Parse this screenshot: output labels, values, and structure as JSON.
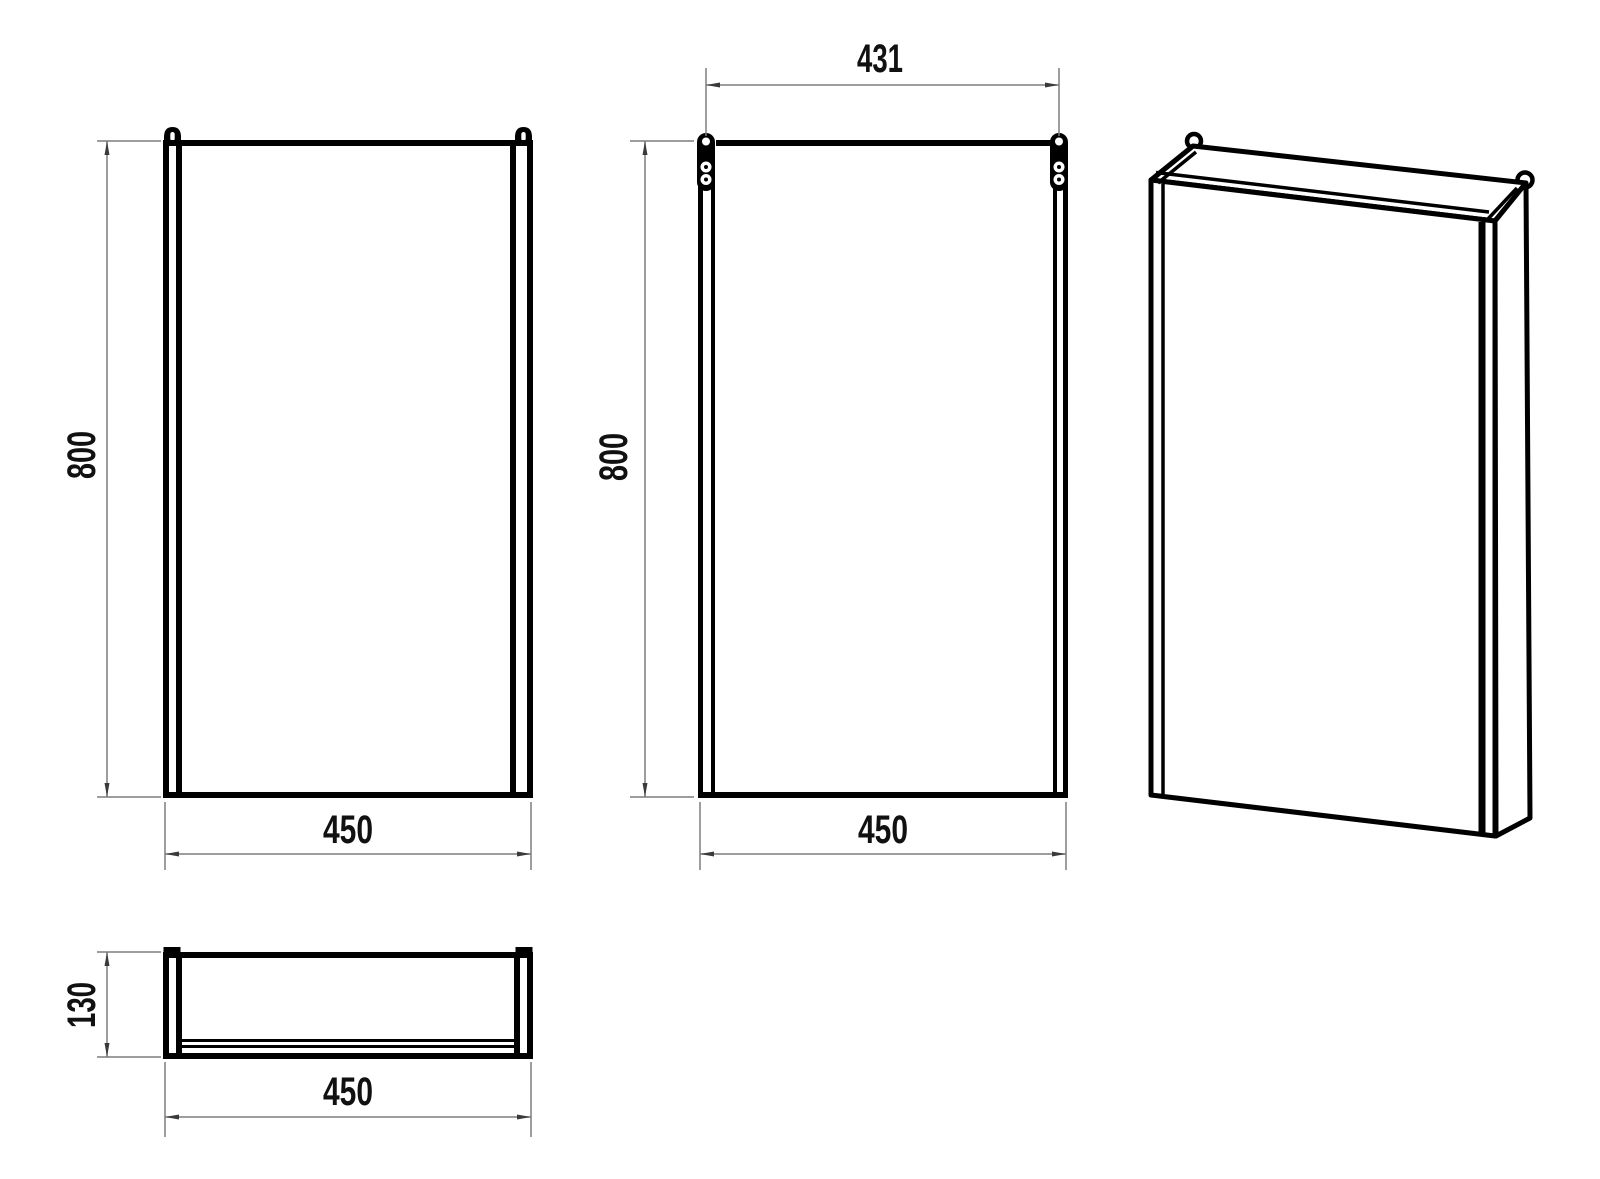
{
  "document": {
    "type": "technical-drawing",
    "subject": "wall-hung cabinet dimensional drawing"
  },
  "views": {
    "front": {
      "height": "800",
      "width": "450"
    },
    "back": {
      "height": "800",
      "width": "450",
      "hanger_spacing": "431"
    },
    "plan": {
      "depth": "130",
      "width": "450"
    }
  },
  "colors": {
    "line": "#000000",
    "dimension_line": "#7d7d7d",
    "arrowhead": "#3a3a3a",
    "background": "#ffffff"
  }
}
